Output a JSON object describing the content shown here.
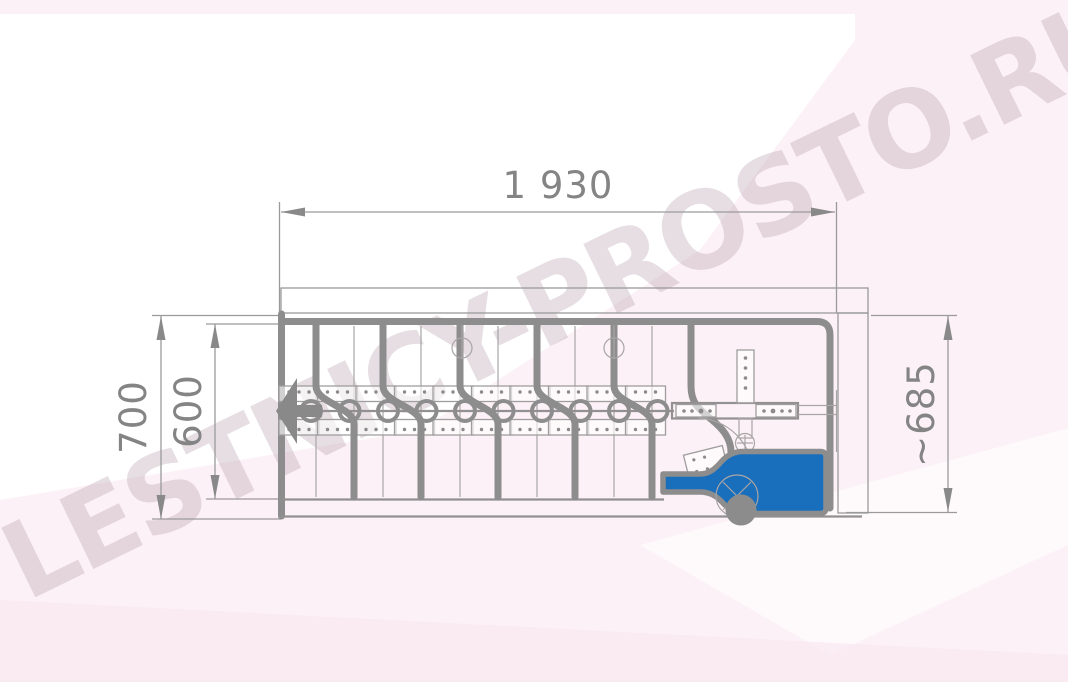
{
  "title": "Folding attic ladder technical drawing (folded, side view)",
  "watermark": {
    "text": "LESTNICY-PROSTO.RU"
  },
  "dimensions": {
    "width_top": {
      "label": "1 930"
    },
    "height_outer": {
      "label": "700"
    },
    "height_inner": {
      "label": "600"
    },
    "height_right": {
      "label": "~685"
    }
  },
  "colors": {
    "line_gray": "#8e8d8d",
    "dim_text_gray": "#848484",
    "accent_blue": "#1a6fbc",
    "background_pink": "#fcf1f6",
    "watermark_color": "rgba(172,146,160,0.30)"
  },
  "icons": [
    {
      "name": "pull-direction-arrow-icon",
      "meaning": "extension direction of folded ladder"
    }
  ]
}
